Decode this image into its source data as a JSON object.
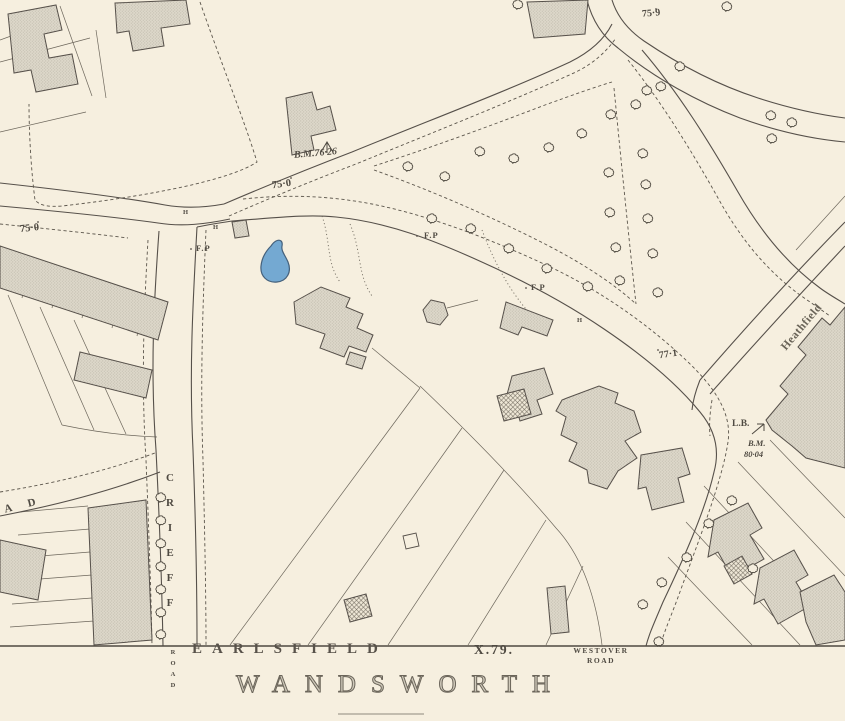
{
  "colors": {
    "paper": "#f6efdf",
    "ink": "#56504a",
    "label-ink": "#4f4a42",
    "building-fill": "#ddd8ca",
    "building-dot": "#a9a193",
    "pond-fill": "#74a9d2",
    "pond-outline": "#44607b"
  },
  "labels": {
    "region": {
      "earlsfield": "EARLSFIELD",
      "wandsworth": "WANDSWORTH",
      "sheet_ref": "X.79."
    },
    "streets": {
      "crieff": "CRIEFF",
      "crieff_road_word": "ROAD",
      "westover_line1": "WESTOVER",
      "westover_line2": "ROAD",
      "road_name_partial": "A D",
      "heathfield": "Heathfield"
    },
    "spot_heights": {
      "west_75_0": "75·0",
      "center_75_0": "75·0",
      "northeast_75_9": "75·9",
      "east_77_1": "77·1"
    },
    "benchmarks": {
      "center": "B.M.76·26",
      "right_bm": "B.M.",
      "right_value": "80·04",
      "letter_box": "L.B."
    },
    "footpaths": {
      "west": "F.P",
      "mid": "F.P",
      "east": "F.P"
    },
    "hydrants": {
      "h1": "H",
      "h2": "H",
      "h3": "H"
    }
  }
}
